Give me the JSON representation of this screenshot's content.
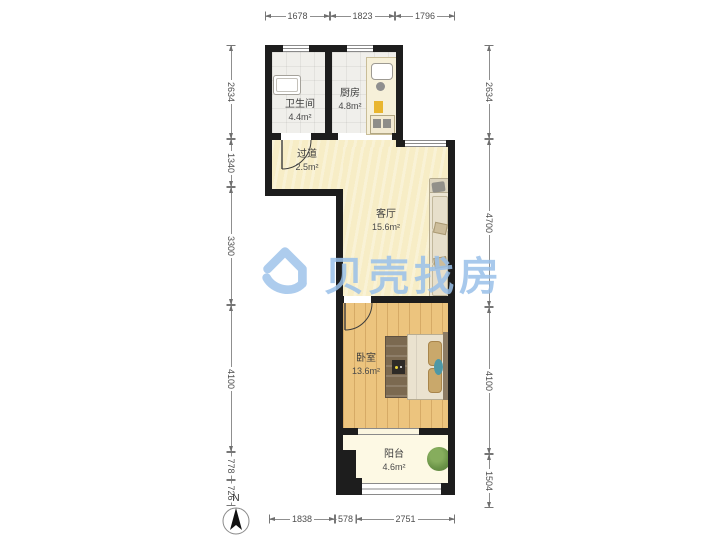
{
  "watermark": {
    "brand": "贝壳找房"
  },
  "compass": {
    "north_label": "N"
  },
  "rooms": {
    "bathroom": {
      "name": "卫生间",
      "area": "4.4m²"
    },
    "kitchen": {
      "name": "厨房",
      "area": "4.8m²"
    },
    "hallway": {
      "name": "过道",
      "area": "2.5m²"
    },
    "living_room": {
      "name": "客厅",
      "area": "15.6m²"
    },
    "bedroom": {
      "name": "卧室",
      "area": "13.6m²"
    },
    "balcony": {
      "name": "阳台",
      "area": "4.6m²"
    }
  },
  "dimensions_mm": {
    "top": [
      "1678",
      "1823",
      "1796"
    ],
    "bottom": [
      "1838",
      "578",
      "2751"
    ],
    "left": [
      "2634",
      "1340",
      "3300",
      "4100",
      "778",
      "726"
    ],
    "right": [
      "2634",
      "4700",
      "4100",
      "1504"
    ]
  },
  "colors": {
    "wall": "#1d1d1d",
    "tile_floor": "#f0efeb",
    "wood_floor": "#ecc47e",
    "living_floor": "#f7edc6",
    "balcony_floor": "#fdf9e4",
    "watermark_blue": "#99c0e9"
  }
}
